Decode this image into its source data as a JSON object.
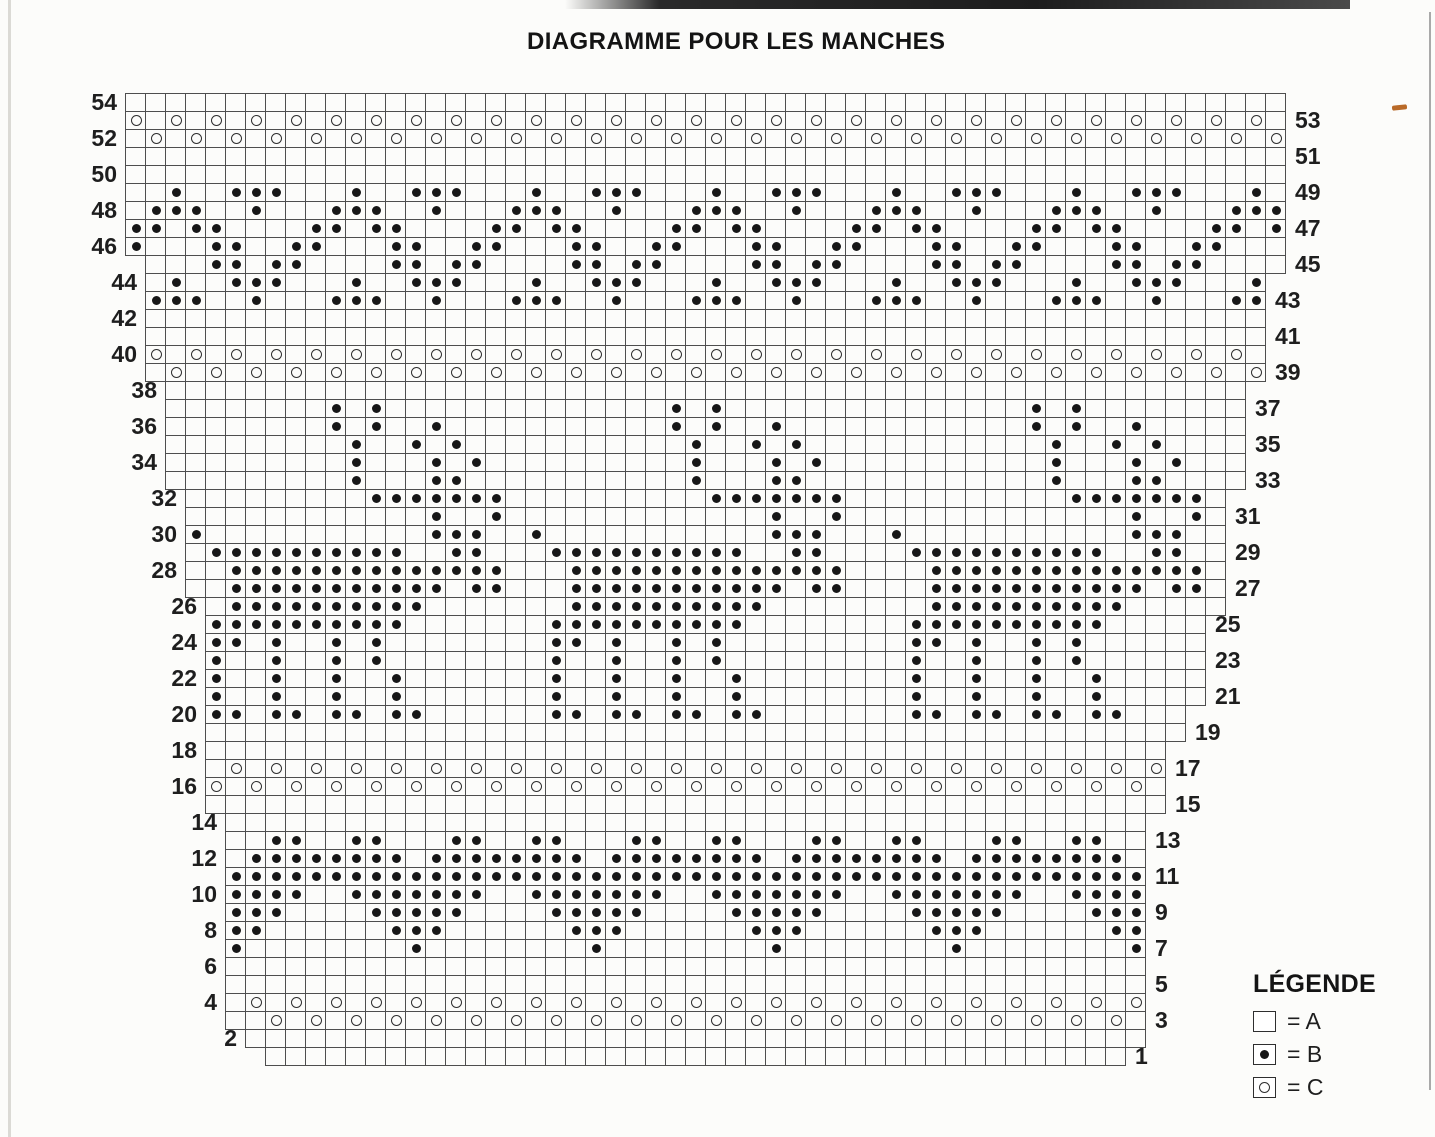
{
  "title": "DIAGRAMME POUR LES MANCHES",
  "legend": {
    "title": "LÉGENDE",
    "items": [
      {
        "symbol": "empty-square",
        "label": "= A"
      },
      {
        "symbol": "dot-square",
        "label": "= B"
      },
      {
        "symbol": "circle-square",
        "label": "= C"
      }
    ]
  },
  "colors": {
    "paper": "#fcfcfa",
    "ink": "#171717",
    "grid_line": "#4e4e4e",
    "artifact_orange": "#b96a28"
  },
  "chart_data": {
    "type": "heatmap",
    "subtype": "knitting-colorwork-chart",
    "title": "DIAGRAMME POUR LES MANCHES",
    "columns": 58,
    "rows": 54,
    "cell_codes": {
      ".": "A (empty square)",
      "B": "B (filled dot)",
      "C": "C (open circle)",
      " ": "outside stair-stepped chart edge"
    },
    "row_numbering": "even row numbers printed on the left edge, odd row numbers printed on the right edge, bottom row is 1",
    "left_row_labels": [
      54,
      52,
      50,
      48,
      46,
      44,
      42,
      40,
      38,
      36,
      34,
      32,
      30,
      28,
      26,
      24,
      22,
      20,
      18,
      16,
      14,
      12,
      10,
      8,
      6,
      4,
      2
    ],
    "right_row_labels": [
      53,
      51,
      49,
      47,
      45,
      43,
      41,
      39,
      37,
      35,
      33,
      31,
      29,
      27,
      25,
      23,
      21,
      19,
      17,
      15,
      13,
      11,
      9,
      7,
      5,
      3,
      1
    ],
    "motifs": [
      "alternating circle separator bands (rows 52-53, 39-40, 16-17, 3-4)",
      "zigzag wave band rows 43-49",
      "three reindeer with antlers rows 20-37",
      "heart border rows 7-13"
    ],
    "grid_rows": [
      {
        "row": 54,
        "cells": ".........................................................."
      },
      {
        "row": 53,
        "cells": "C.C.C.C.C.C.C.C.C.C.C.C.C.C.C.C.C.C.C.C.C.C.C.C.C.C.C.C.C."
      },
      {
        "row": 52,
        "cells": ".C.C.C.C.C.C.C.C.C.C.C.C.C.C.C.C.C.C.C.C.C.C.C.C.C.C.C.C.C"
      },
      {
        "row": 51,
        "cells": ".........................................................."
      },
      {
        "row": 50,
        "cells": ".........................................................."
      },
      {
        "row": 49,
        "cells": "..B..BBB...B..BBB...B..BBB...B..BBB...B..BBB...B..BBB...B."
      },
      {
        "row": 48,
        "cells": ".BBB..B...BBB..B...BBB..B...BBB..B...BBB..B...BBB..B...BBB"
      },
      {
        "row": 47,
        "cells": "BB.BB....BB.BB....BB.BB....BB.BB....BB.BB....BB.BB....BB.B"
      },
      {
        "row": 46,
        "cells": "B...BB..BB...BB..BB...BB..BB...BB..BB...BB..BB...BB..BB..."
      },
      {
        "row": 45,
        "cells": " ...BB.BB....BB.BB....BB.BB....BB.BB....BB.BB....BB.BB...."
      },
      {
        "row": 44,
        "cells": " .B..BBB...B..BBB...B..BBB...B..BBB...B..BBB...B..BBB...B "
      },
      {
        "row": 43,
        "cells": " BBB..B...BBB..B...BBB..B...BBB..B...BBB..B...BBB..B...BB "
      },
      {
        "row": 42,
        "cells": " ........................................................ "
      },
      {
        "row": 41,
        "cells": " ........................................................ "
      },
      {
        "row": 40,
        "cells": " C.C.C.C.C.C.C.C.C.C.C.C.C.C.C.C.C.C.C.C.C.C.C.C.C.C.C.C. "
      },
      {
        "row": 39,
        "cells": " .C.C.C.C.C.C.C.C.C.C.C.C.C.C.C.C.C.C.C.C.C.C.C.C.C.C.C.C "
      },
      {
        "row": 38,
        "cells": "  ......................................................  "
      },
      {
        "row": 37,
        "cells": "  ........B.B..............B.B...............B.B........  "
      },
      {
        "row": 36,
        "cells": "  ........B.B..B...........B.B..B............B.B..B.....  "
      },
      {
        "row": 35,
        "cells": "  .........B..B.B...........B..B.B............B..B.B....  "
      },
      {
        "row": 34,
        "cells": "  .........B...B.B..........B...B.B...........B...B.B...  "
      },
      {
        "row": 33,
        "cells": "  .........B...BB...........B...BB............B...BB....  "
      },
      {
        "row": 32,
        "cells": "   .........BBBBBBB..........BBBBBBB...........BBBBBBB.   "
      },
      {
        "row": 31,
        "cells": "   ............B..B.............B..B..............B..B.   "
      },
      {
        "row": 30,
        "cells": "   B...........BBB..B...........BBB...B...........BBB..   "
      },
      {
        "row": 29,
        "cells": "   .BBBBBBBBBB..BB...BBBBBBBBBB..BB....BBBBBBBBBB..BB..   "
      },
      {
        "row": 28,
        "cells": "   ..BBBBBBBBBBBBBB...BBBBBBBBBBBBBB....BBBBBBBBBBBBBB.   "
      },
      {
        "row": 27,
        "cells": "   ..BBBBBBBBBBB.BB...BBBBBBBBBBB.BB....BBBBBBBBBBB.BB.   "
      },
      {
        "row": 26,
        "cells": "    .BBBBBBBBBB.......BBBBBBBBBB........BBBBBBBBBB.....   "
      },
      {
        "row": 25,
        "cells": "    BBBBBBBBBB.......BBBBBBBBBB........BBBBBBBBBB.....    "
      },
      {
        "row": 24,
        "cells": "    BB.B..B.B........BB.B..B.B.........BB.B..B.B......    "
      },
      {
        "row": 23,
        "cells": "    B..B..B.B........B..B..B.B.........B..B..B.B......    "
      },
      {
        "row": 22,
        "cells": "    B..B..B..B.......B..B..B..B........B..B..B..B.....    "
      },
      {
        "row": 21,
        "cells": "    B..B..B..B.......B..B..B..B........B..B..B..B.....    "
      },
      {
        "row": 20,
        "cells": "    BB.BB.BB.BB......BB.BB.BB.BB.......BB.BB.BB.BB...     "
      },
      {
        "row": 19,
        "cells": "    .................................................     "
      },
      {
        "row": 18,
        "cells": "    ................................................      "
      },
      {
        "row": 17,
        "cells": "    .C.C.C.C.C.C.C.C.C.C.C.C.C.C.C.C.C.C.C.C.C.C.C.C      "
      },
      {
        "row": 16,
        "cells": "    C.C.C.C.C.C.C.C.C.C.C.C.C.C.C.C.C.C.C.C.C.C.C.C.      "
      },
      {
        "row": 15,
        "cells": "    ................................................      "
      },
      {
        "row": 14,
        "cells": "     ..............................................       "
      },
      {
        "row": 13,
        "cells": "     ..BB..BB...BB..BB...BB..BB...BB..BB...BB..BB..       "
      },
      {
        "row": 12,
        "cells": "     .BBBBBBBB.BBBBBBBB.BBBBBBBB.BBBBBBBB.BBBBBBBB.       "
      },
      {
        "row": 11,
        "cells": "     BBBBBBBBBBBBBBBBBBBBBBBBBBBBBBBBBBBBBBBBBBBBBB       "
      },
      {
        "row": 10,
        "cells": "     BBBB..BBBBBBB..BBBBBBB..BBBBBBB..BBBBBBB..BBBB       "
      },
      {
        "row": 9,
        "cells": "     BBB....BBBBB....BBBBB....BBBBB....BBBBB....BBB       "
      },
      {
        "row": 8,
        "cells": "     BB......BBB......BBB......BBB......BBB......BB       "
      },
      {
        "row": 7,
        "cells": "     B........B........B........B........B........B       "
      },
      {
        "row": 6,
        "cells": "     ..............................................       "
      },
      {
        "row": 5,
        "cells": "     ..............................................       "
      },
      {
        "row": 4,
        "cells": "     .C.C.C.C.C.C.C.C.C.C.C.C.C.C.C.C.C.C.C.C.C.C.C       "
      },
      {
        "row": 3,
        "cells": "     ..C.C.C.C.C.C.C.C.C.C.C.C.C.C.C.C.C.C.C.C.C.C.       "
      },
      {
        "row": 2,
        "cells": "      .............................................       "
      },
      {
        "row": 1,
        "cells": "       ...........................................        "
      }
    ]
  }
}
